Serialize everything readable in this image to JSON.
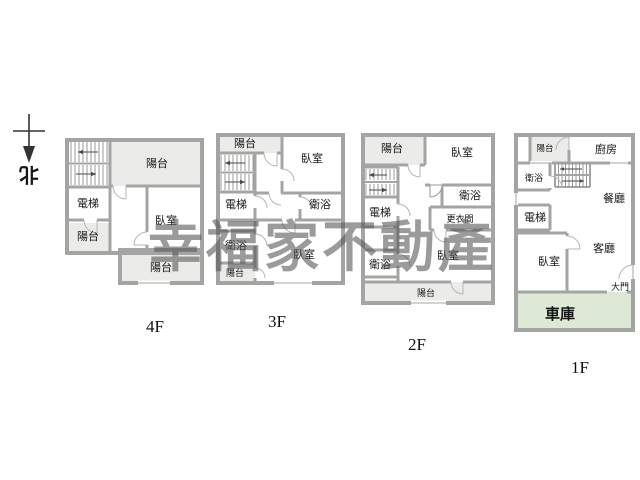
{
  "watermark": {
    "text": "幸福家不動產",
    "color": "#585858"
  },
  "compass": {
    "label": "北"
  },
  "colors": {
    "wall": "#a4a4a2",
    "balcony_fill": "#ebebe9",
    "garage_fill": "#dde9d5",
    "label": "#161616"
  },
  "floors": [
    {
      "name": "4F",
      "rooms": {
        "balcony_top": "陽台",
        "elevator": "電梯",
        "balcony_left": "陽台",
        "bedroom": "臥室",
        "balcony_bottom": "陽台"
      }
    },
    {
      "name": "3F",
      "rooms": {
        "balcony_top": "陽台",
        "bedroom_top": "臥室",
        "elevator": "電梯",
        "bath_right": "衛浴",
        "bath_left": "衛浴",
        "balcony_bottom": "陽台",
        "bedroom_bottom": "臥室"
      }
    },
    {
      "name": "2F",
      "rooms": {
        "balcony_top": "陽台",
        "bedroom_top": "臥室",
        "elevator": "電梯",
        "bath_right": "衛浴",
        "dressing": "更衣間",
        "bath_left": "衛浴",
        "bedroom_bottom": "臥室",
        "balcony_bottom": "陽台"
      }
    },
    {
      "name": "1F",
      "rooms": {
        "balcony": "陽台",
        "kitchen": "廚房",
        "bath": "衛浴",
        "elevator": "電梯",
        "dining": "餐廳",
        "living": "客廳",
        "bedroom": "臥室",
        "gate": "大門",
        "garage": "車庫"
      }
    }
  ]
}
